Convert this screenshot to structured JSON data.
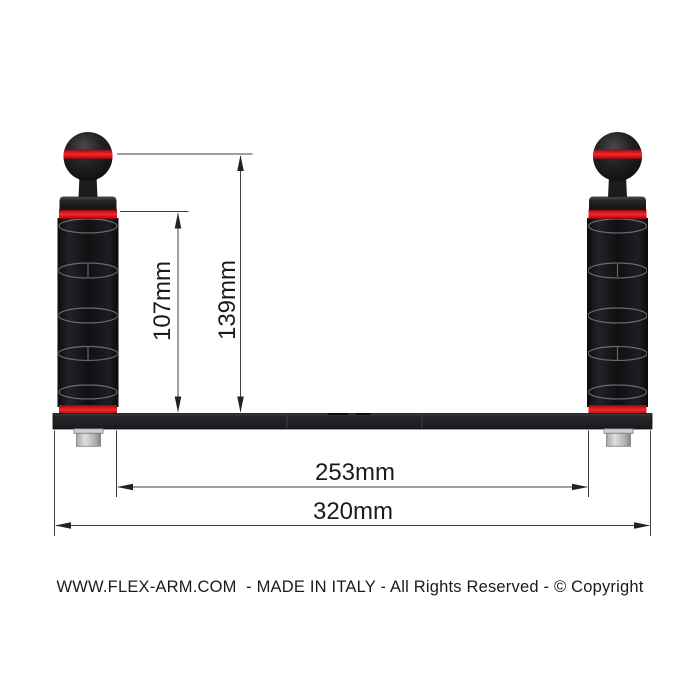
{
  "diagram": {
    "title": "flex-arm double handle tray technical drawing",
    "labels": {
      "flex_body_height": "107mm",
      "ball_top_height": "139mm",
      "inner_span": "253mm",
      "tray_width": "320mm"
    },
    "footer": "WWW.FLEX-ARM.COM  - MADE IN ITALY - All Rights Reserved - © Copyright",
    "colors": {
      "accent_red": "#e2201f",
      "part_black": "#18181a",
      "tray_black": "#232326",
      "bolt_gray": "#bfbfbf",
      "dim_line": "#3f3f3f",
      "text": "#1b1b1b",
      "background": "#ffffff"
    }
  }
}
